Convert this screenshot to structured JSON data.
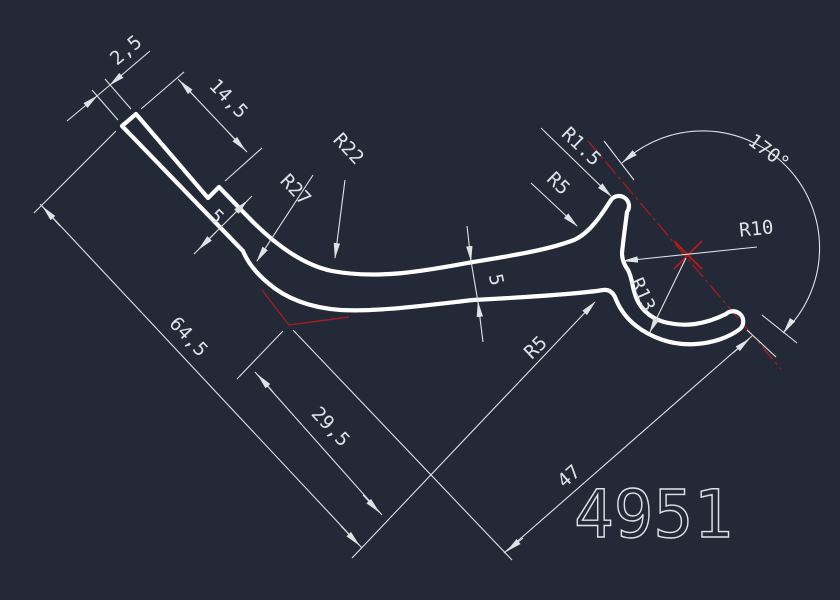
{
  "drawing": {
    "part_number": "4951",
    "background_color": "#232936",
    "geometry_color": "#ffffff",
    "dimension_color": "#dfe3e8",
    "centerline_color": "#a01d22",
    "dimensions": {
      "cap_width": "2,5",
      "tab_length": "14,5",
      "step_thickness": "5",
      "band_thickness": "5",
      "overall_length": "64,5",
      "mid_length": "29,5",
      "hook_length": "47",
      "tip_angle": "170°"
    },
    "radii": {
      "outer_bend": "R27",
      "inner_bend": "R22",
      "branch_tip": "R1.5",
      "branch_fillet": "R5",
      "hook_fillet": "R5",
      "hook_inner": "R13",
      "hook_center": "R10"
    }
  }
}
